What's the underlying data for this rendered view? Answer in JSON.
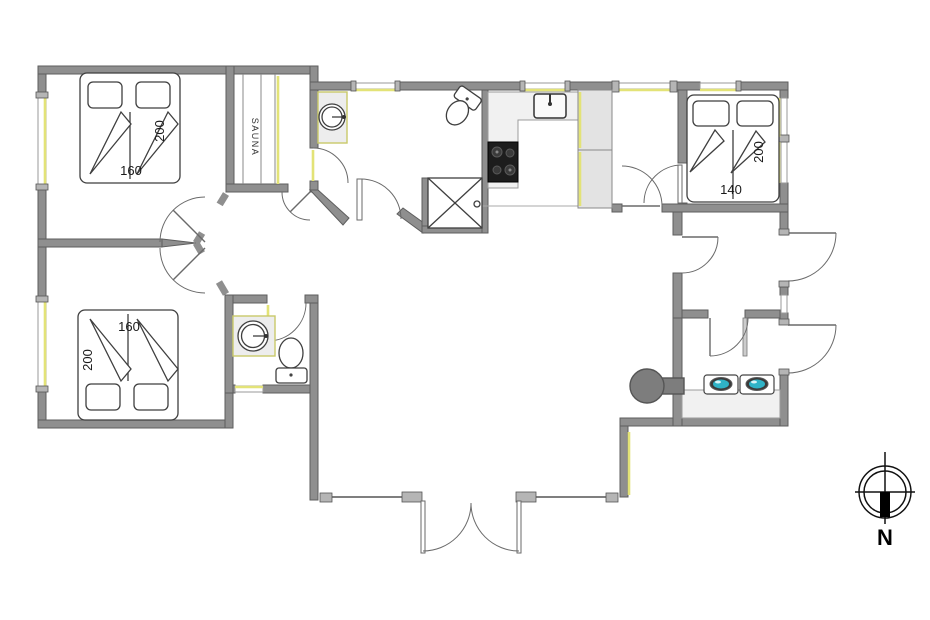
{
  "plan": {
    "type": "floor-plan",
    "labels": {
      "sauna": "SAUNA",
      "bedroom_top_left_width": "160",
      "bedroom_top_left_length": "200",
      "bedroom_bottom_left_width": "160",
      "bedroom_bottom_left_length": "200",
      "bedroom_right_width": "140",
      "bedroom_right_length": "200",
      "compass_north": "N"
    },
    "icons": [
      "double-bed-icon",
      "single-beds-icon",
      "pillow-icon",
      "sauna-bench-icon",
      "washbasin-icon",
      "toilet-icon",
      "shower-icon",
      "kitchen-sink-icon",
      "cooktop-icon",
      "gas-burner-icon",
      "wood-stove-icon",
      "door-swing-icon",
      "window-icon",
      "compass-rose-icon"
    ]
  },
  "colors": {
    "wall": "#8f8f8f",
    "wall_edge": "#5e5e5e",
    "window_accent": "#e3e377",
    "cooktop": "#1d1d1d",
    "flame": "#2fb3c7",
    "wood_stove": "#7d7d7d",
    "counter": "#f1f1f1",
    "line": "#3f3f3f"
  }
}
